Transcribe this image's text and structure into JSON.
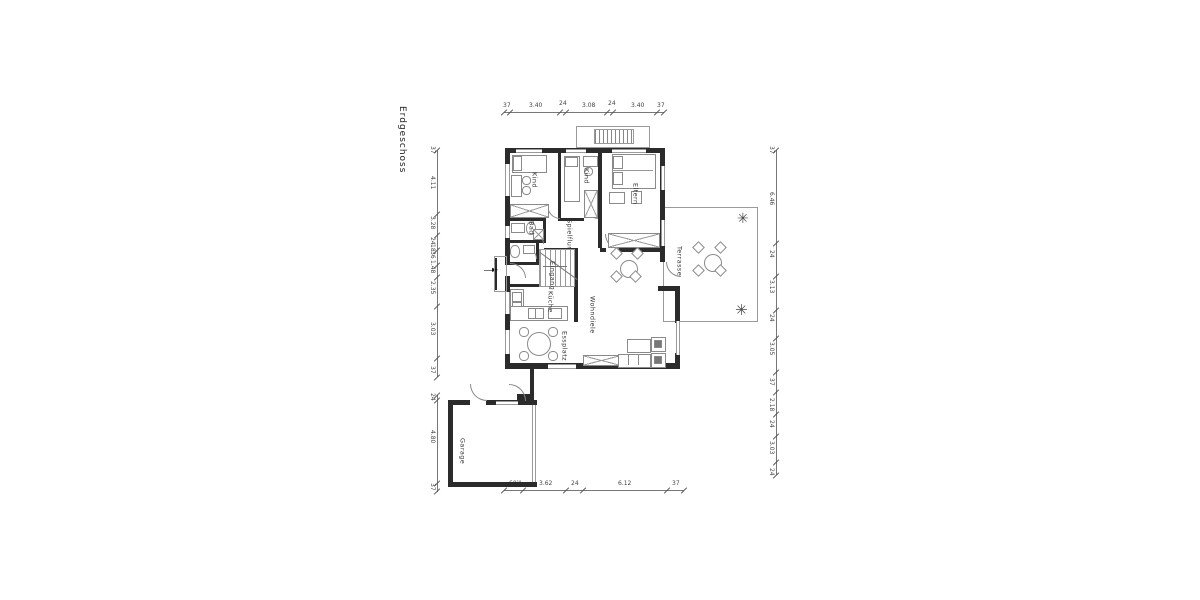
{
  "title": "Erdgeschoss",
  "rooms": {
    "kind1": "Kind",
    "kind2": "Kind",
    "eltern": "Eltern",
    "bad": "Bad",
    "spielflur": "Spielflur",
    "eingang": "Eingang",
    "kueche": "Küche",
    "essplatz": "Essplatz",
    "wohndiele": "Wohndiele",
    "terrasse": "Terrasse",
    "garage": "Garage"
  },
  "dimensions": {
    "top": [
      "37",
      "3.40",
      "24",
      "3.08",
      "24",
      "3.40",
      "37"
    ],
    "left": [
      "37",
      "4.11",
      "3.28",
      "24",
      "18",
      "36",
      "1.48",
      "2.35",
      "3.03",
      "37"
    ],
    "right": [
      "37",
      "6.46",
      "24",
      "3.13",
      "24",
      "3.05",
      "37",
      "2.18",
      "24",
      "3.03",
      "24"
    ],
    "bottom": [
      "60¹⁸",
      "3.62",
      "24",
      "6.12",
      "37"
    ],
    "garage_left": [
      "24",
      "4.80",
      "37"
    ]
  },
  "icons": {
    "plant": "✳",
    "entry_arrow": "►"
  },
  "colors": {
    "wall": "#2b2b2b",
    "line": "#8a8a8a"
  }
}
